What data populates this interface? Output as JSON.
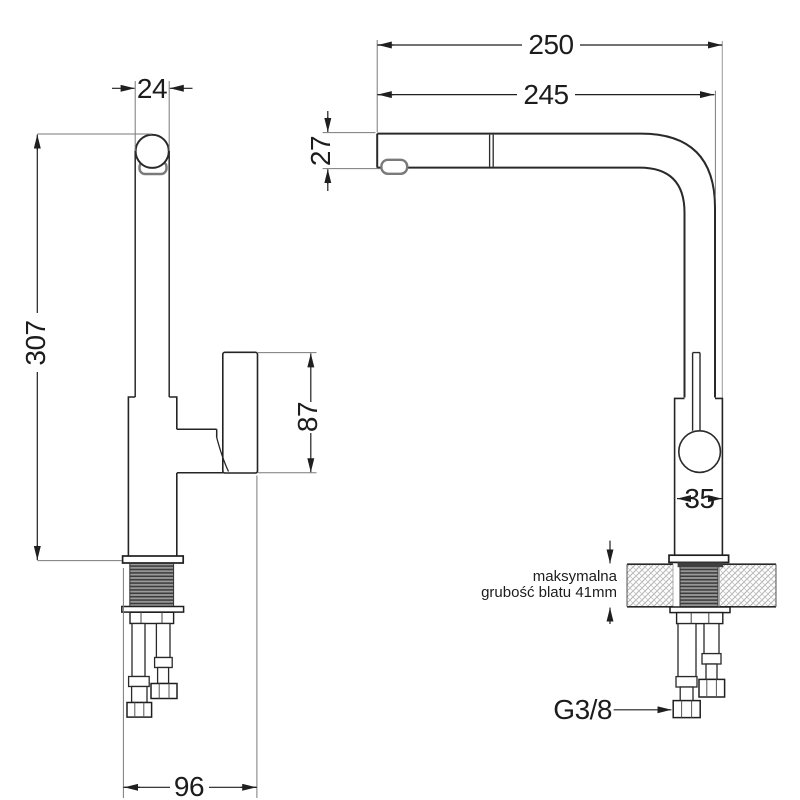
{
  "drawing_type": "faucet-installation-technical-drawing",
  "dimensions": {
    "front": {
      "spout_width": "24",
      "height": "307",
      "handle_length": "87",
      "base_depth": "96"
    },
    "side": {
      "reach_total": "250",
      "reach_spout": "245",
      "spout_height": "27",
      "body_width": "35"
    }
  },
  "annotations": {
    "thread_size": "G3/8",
    "counter_note_line1": "maksymalna",
    "counter_note_line2": "grubość blatu 41mm"
  },
  "colors": {
    "line": "#1f1f1f",
    "extension_line": "#7a7a7a",
    "aerator_outline": "#7a7a7a",
    "hatch": "#b0b0b0",
    "thread_dark": "#3c3c3c",
    "thread_light": "#9b9b9b",
    "background": "#ffffff"
  }
}
